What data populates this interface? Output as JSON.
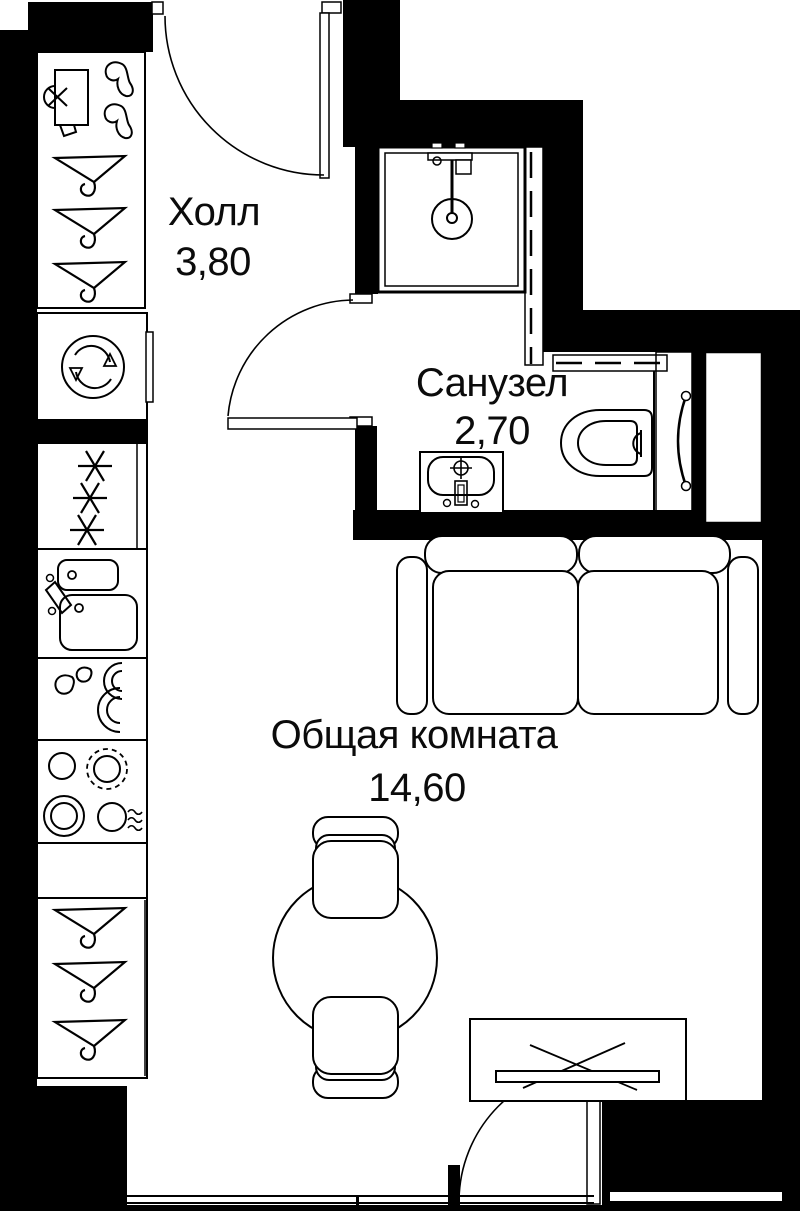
{
  "rooms": {
    "hall": {
      "label": "Холл",
      "area": "3,80"
    },
    "bathroom": {
      "label": "Санузел",
      "area": "2,70"
    },
    "living_room": {
      "label": "Общая комната",
      "area": "14,60"
    }
  },
  "colors": {
    "walls": "#000000",
    "lines": "#000000",
    "background": "#ffffff"
  },
  "fixtures": [
    "wardrobe-hangers",
    "shoe-shelf",
    "washing-machine",
    "refrigerator",
    "kitchen-sink",
    "dishwasher",
    "stove",
    "kitchen-counter",
    "wardrobe-2",
    "shower-cabin",
    "bathroom-sink",
    "toilet",
    "towel-rail",
    "duct-shaft",
    "sofa",
    "round-table",
    "chair",
    "desk",
    "entrance-door",
    "bathroom-door",
    "balcony-door",
    "window"
  ]
}
